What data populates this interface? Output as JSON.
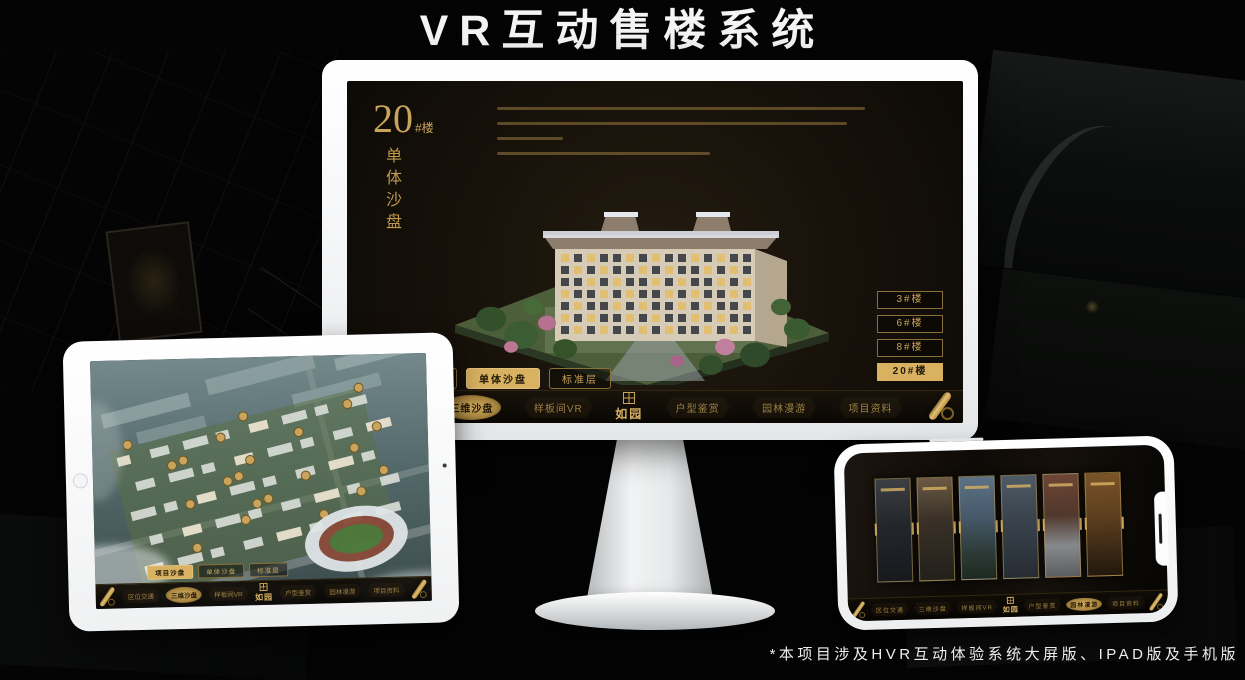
{
  "header": {
    "title": "VR互动售楼系统"
  },
  "footer": {
    "note": "*本项目涉及HVR互动体验系统大屏版、IPAD版及手机版"
  },
  "colors": {
    "gold": "#c9a45c",
    "gold_active": "#d9b261",
    "screen_bg": "#17110a"
  },
  "monitor_app": {
    "heading_number": "20",
    "heading_suffix": "#楼",
    "heading_subtitle": "单体沙盘",
    "floor_buttons": [
      {
        "label": "3#楼",
        "active": false
      },
      {
        "label": "6#楼",
        "active": false
      },
      {
        "label": "8#楼",
        "active": false
      },
      {
        "label": "20#楼",
        "active": true
      }
    ],
    "mode_tabs": [
      {
        "label": "项目沙盘",
        "active": false
      },
      {
        "label": "单体沙盘",
        "active": true
      },
      {
        "label": "标准层",
        "active": false
      }
    ],
    "logo": "如园",
    "nav_items": [
      {
        "label": "区位交通",
        "active": false
      },
      {
        "label": "三维沙盘",
        "active": true
      },
      {
        "label": "样板间VR",
        "active": false
      },
      {
        "label": "户型鉴赏",
        "active": false
      },
      {
        "label": "园林漫游",
        "active": false
      },
      {
        "label": "项目资料",
        "active": false
      }
    ]
  },
  "tablet_app": {
    "mode_tabs": [
      {
        "label": "项目沙盘",
        "active": true
      },
      {
        "label": "单体沙盘",
        "active": false
      },
      {
        "label": "标准层",
        "active": false
      }
    ],
    "logo": "如园",
    "nav_items": [
      {
        "label": "区位交通",
        "active": false
      },
      {
        "label": "三维沙盘",
        "active": true
      },
      {
        "label": "样板间VR",
        "active": false
      },
      {
        "label": "户型鉴赏",
        "active": false
      },
      {
        "label": "园林漫游",
        "active": false
      },
      {
        "label": "项目资料",
        "active": false
      }
    ]
  },
  "phone_app": {
    "logo": "如园",
    "nav_items": [
      {
        "label": "区位交通",
        "active": false
      },
      {
        "label": "三维沙盘",
        "active": false
      },
      {
        "label": "样板间VR",
        "active": false
      },
      {
        "label": "户型鉴赏",
        "active": false
      },
      {
        "label": "园林漫游",
        "active": true
      },
      {
        "label": "项目资料",
        "active": false
      }
    ],
    "gallery_cards": [
      {
        "scene": "courtyard"
      },
      {
        "scene": "wood-interior"
      },
      {
        "scene": "dusk-tower"
      },
      {
        "scene": "facade"
      },
      {
        "scene": "autumn-court"
      },
      {
        "scene": "warm-shelf"
      }
    ]
  }
}
